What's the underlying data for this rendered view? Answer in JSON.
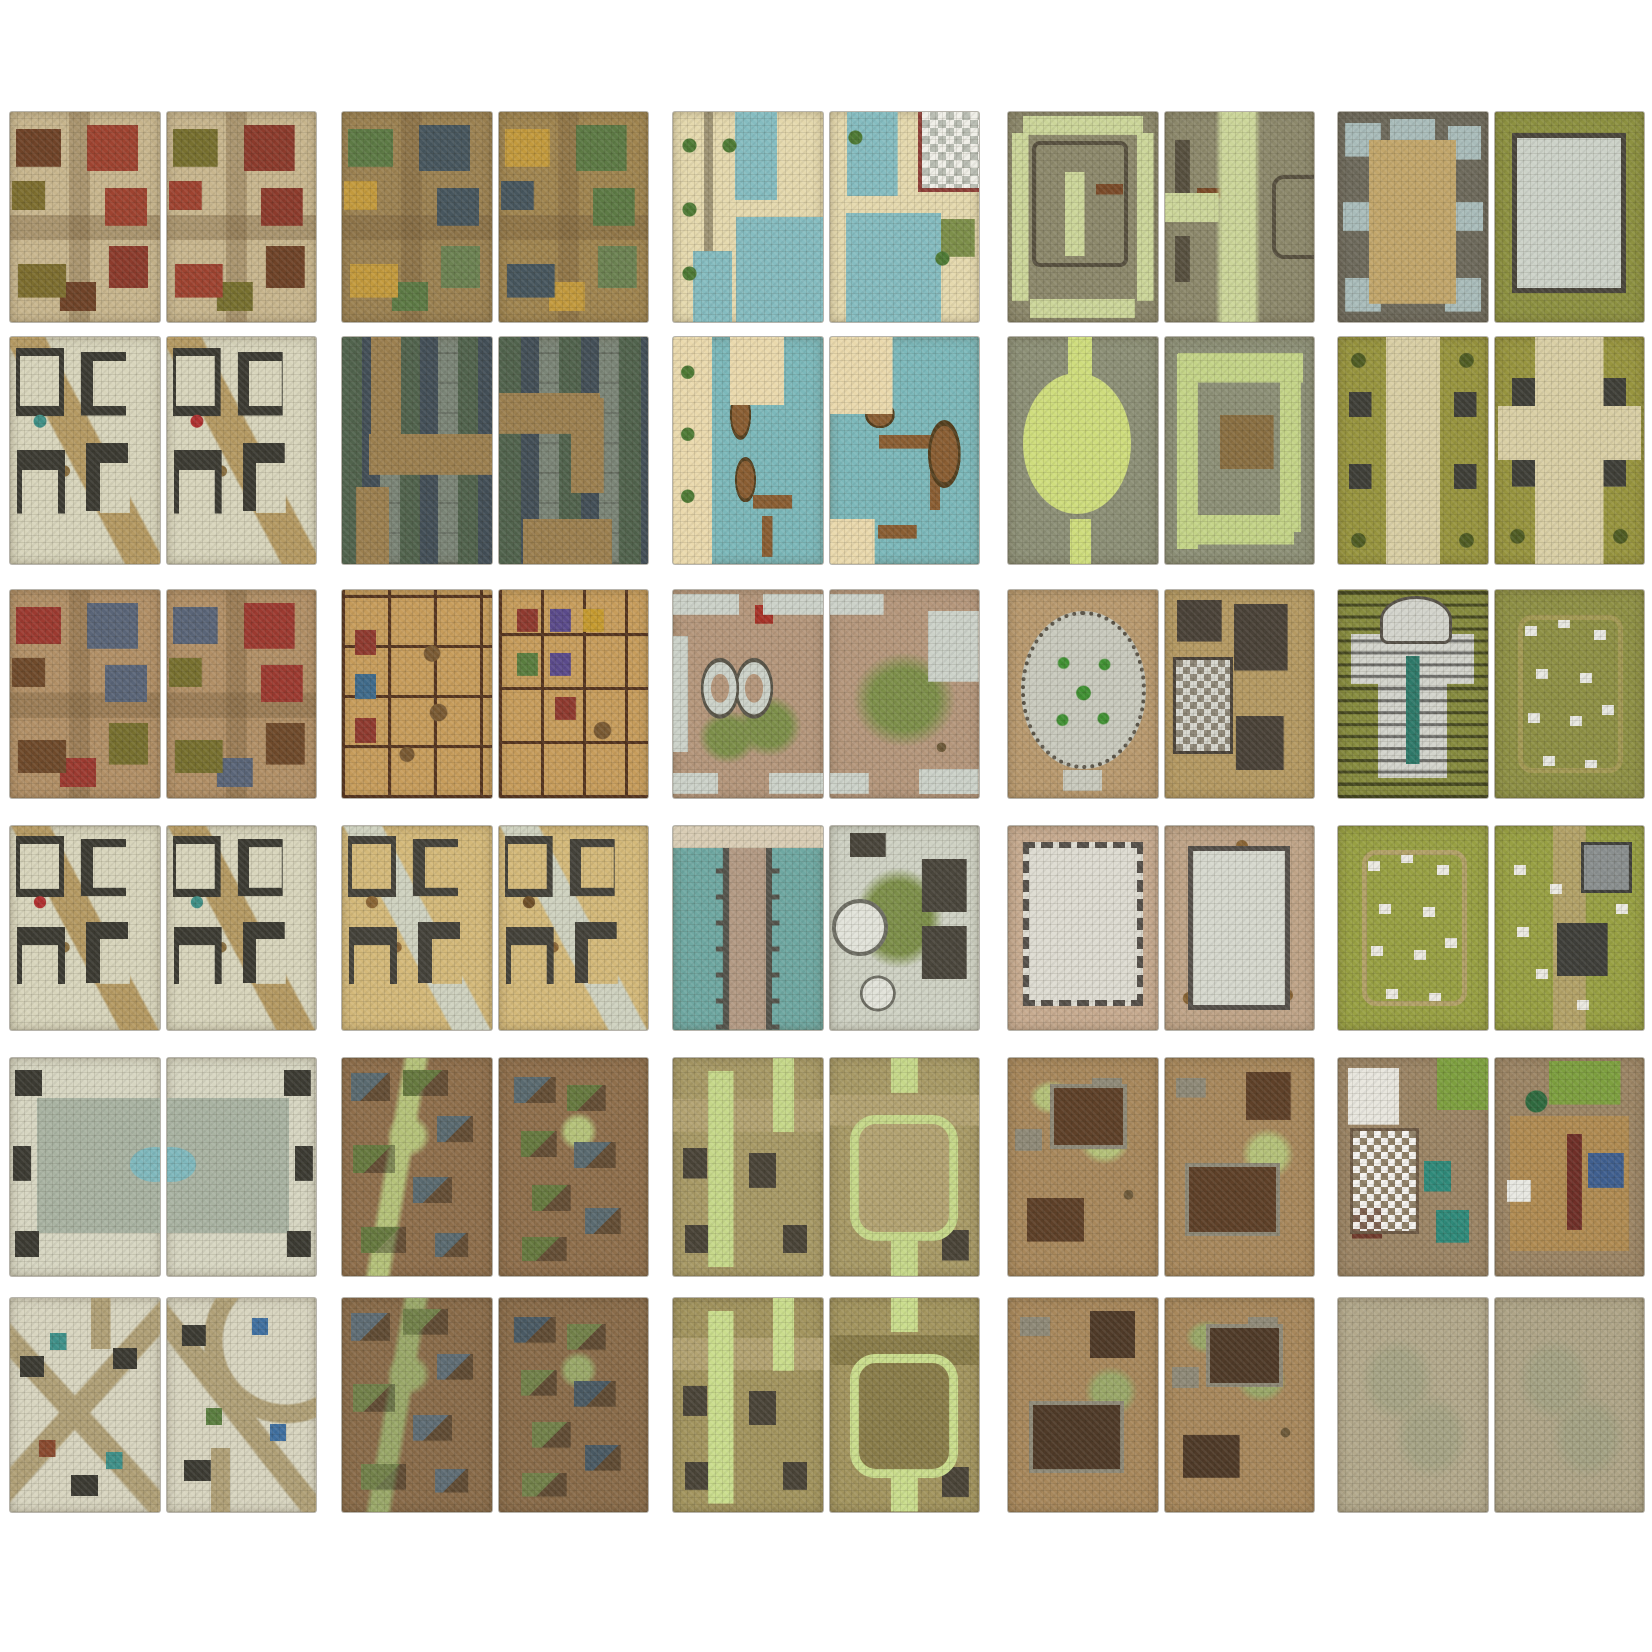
{
  "page": {
    "description": "Grid of 30 fantasy battle-map tiles, each split into two tall panels, arranged five across by six down on a white background",
    "background_color": "#ffffff",
    "grid_rows": 6,
    "grid_cols": 5
  },
  "grid": {
    "tiles": [
      {
        "id": "r1c1",
        "row": 1,
        "col": 1,
        "name": "city-red-rooftops",
        "description": "City crossroads flanked by red, brown and olive hip roofs over cobbled streets",
        "panels": [
          {
            "kind": "city",
            "base": "#c8b68e",
            "accents": [
              "#9e4330",
              "#6f4328",
              "#7d6e2f",
              "#8c3b2c"
            ]
          },
          {
            "kind": "city",
            "base": "#c8b68e",
            "accents": [
              "#8c3b2c",
              "#77702f",
              "#9e4330",
              "#6f4328"
            ]
          }
        ]
      },
      {
        "id": "r1c2",
        "row": 1,
        "col": 2,
        "name": "town-green-rooftops",
        "description": "Town streets winding between slate and green rooftops with gold courtyards",
        "panels": [
          {
            "kind": "city",
            "base": "#9c8252",
            "accents": [
              "#47565e",
              "#5d7a45",
              "#c39a3d",
              "#6c8252"
            ]
          },
          {
            "kind": "city",
            "base": "#a08550",
            "accents": [
              "#5d7a45",
              "#c39a3d",
              "#47565e",
              "#6c8252"
            ]
          }
        ]
      },
      {
        "id": "r1c3",
        "row": 1,
        "col": 3,
        "name": "canal-quarter",
        "description": "Canal quarter with teal waterways, stone quays, trees and a checkered plaza",
        "panels": [
          {
            "kind": "canal",
            "base": "#e5d9ae",
            "accents": [
              "#85bcc0",
              "#4e7a35",
              "#8e4038"
            ]
          },
          {
            "kind": "canal2",
            "base": "#e5d9ae",
            "accents": [
              "#85bcc0",
              "#4e7a35",
              "#b9bdb3"
            ]
          }
        ]
      },
      {
        "id": "r1c4",
        "row": 1,
        "col": 4,
        "name": "garden-maze-ramparts",
        "description": "Walled garden maze with pale green paths between grey stone ramparts",
        "panels": [
          {
            "kind": "dungeon",
            "base": "#8d896c",
            "accents": [
              "#ccd69a",
              "#57503f",
              "#7a4a28"
            ]
          },
          {
            "kind": "dungeon2",
            "base": "#8d896c",
            "accents": [
              "#ccd69a",
              "#57503f",
              "#7a4a28"
            ]
          }
        ]
      },
      {
        "id": "r1c5",
        "row": 1,
        "col": 5,
        "name": "keep-courtyard",
        "description": "Ruined keep courtyard with side chambers and a tiled great-house on grass",
        "panels": [
          {
            "kind": "keepcourt",
            "base": "#6e6a5c",
            "accents": [
              "#c2a66b",
              "#a9bcba"
            ]
          },
          {
            "kind": "keepgrass",
            "base": "#8d9141",
            "accents": [
              "#ccd2c8",
              "#4a463c"
            ]
          }
        ]
      },
      {
        "id": "r2c1",
        "row": 2,
        "col": 1,
        "name": "city-block-interiors",
        "description": "City block interiors with exposed rooms along a dirt crossroads",
        "panels": [
          {
            "kind": "interiors",
            "base": "#d8d5bc",
            "accents": [
              "#3c3b33",
              "#b59a63",
              "#8a6f3f",
              "#3f8f86"
            ]
          },
          {
            "kind": "interiors",
            "base": "#d8d5bc",
            "accents": [
              "#3c3b33",
              "#b59a63",
              "#8a6f3f",
              "#b03030"
            ]
          }
        ]
      },
      {
        "id": "r2c2",
        "row": 2,
        "col": 2,
        "name": "serpentine-street",
        "description": "Serpentine dirt street snaking between grey and green rooftops",
        "panels": [
          {
            "kind": "serp",
            "base": "#7b8577",
            "accents": [
              "#9c8050",
              "#51634d",
              "#434f57"
            ]
          },
          {
            "kind": "serp2",
            "base": "#7b8577",
            "accents": [
              "#9c8050",
              "#51634d",
              "#434f57"
            ]
          }
        ]
      },
      {
        "id": "r2c3",
        "row": 2,
        "col": 3,
        "name": "harbor-docks",
        "description": "Harbor docks with wooden piers and boats on teal water",
        "panels": [
          {
            "kind": "docks",
            "base": "#7cb8ba",
            "accents": [
              "#ead9ad",
              "#8a5e33",
              "#55401f",
              "#4e7a35"
            ]
          },
          {
            "kind": "docks2",
            "base": "#7cb8ba",
            "accents": [
              "#ead9ad",
              "#8a5e33",
              "#55401f",
              "#4e7a35"
            ]
          }
        ]
      },
      {
        "id": "r2c4",
        "row": 2,
        "col": 4,
        "name": "garden-pond-maze",
        "description": "Round green pond in a stone court beside a winding hedge-path maze",
        "panels": [
          {
            "kind": "pond",
            "base": "#8d9077",
            "accents": [
              "#cfdd7d"
            ]
          },
          {
            "kind": "mazeg",
            "base": "#8d9077",
            "accents": [
              "#c4d488",
              "#8a6f42"
            ]
          }
        ]
      },
      {
        "id": "r2c5",
        "row": 2,
        "col": 5,
        "name": "processional-path",
        "description": "Processional gravel path across grass lined with stone monuments and shrubs",
        "panels": [
          {
            "kind": "grasspath",
            "base": "#98953f",
            "accents": [
              "#d9cfa5",
              "#9aa0a2",
              "#4f5c23"
            ]
          },
          {
            "kind": "grasspath2",
            "base": "#98953f",
            "accents": [
              "#d9cfa5",
              "#9aa0a2",
              "#4f5c23"
            ]
          }
        ]
      },
      {
        "id": "r3c1",
        "row": 3,
        "col": 1,
        "name": "city-dirt-streets",
        "description": "Dirt-street city quarter with blue, red and brown rooftops",
        "panels": [
          {
            "kind": "city",
            "base": "#b29067",
            "accents": [
              "#5a6578",
              "#9c3a30",
              "#6f4a2b",
              "#77702f"
            ]
          },
          {
            "kind": "city",
            "base": "#b29067",
            "accents": [
              "#9c3a30",
              "#5a6578",
              "#77702f",
              "#6f4a2b"
            ]
          }
        ]
      },
      {
        "id": "r3c2",
        "row": 3,
        "col": 2,
        "name": "tavern-inn-interior",
        "description": "Tavern and inn interiors with wooden floors, tables and colored beds",
        "panels": [
          {
            "kind": "tavern",
            "base": "#c79d5c",
            "accents": [
              "#54341f",
              "#7a5a33",
              "#8f3a2f",
              "#3f6a8a"
            ]
          },
          {
            "kind": "tavern2",
            "base": "#c79d5c",
            "accents": [
              "#54341f",
              "#7a5a33",
              "#8f3a2f",
              "#5a4a8a"
            ]
          }
        ]
      },
      {
        "id": "r3c3",
        "row": 3,
        "col": 3,
        "name": "weathered-plaza-basins",
        "description": "Weathered plaza with oval stone basins, grass patches and a red cart",
        "panels": [
          {
            "kind": "oldplaza",
            "base": "#b5977c",
            "accents": [
              "#ccd2c9",
              "#7d8f4a",
              "#a83228"
            ]
          },
          {
            "kind": "oldplaza2",
            "base": "#b5977c",
            "accents": [
              "#ccd2c9",
              "#7d8f4a",
              "#a83228"
            ]
          }
        ]
      },
      {
        "id": "r3c4",
        "row": 3,
        "col": 4,
        "name": "round-plaza-house",
        "description": "Circular flagstone plaza ringed by statues beside house interiors with checkered tile",
        "panels": [
          {
            "kind": "plazaround",
            "base": "#b99a6f",
            "accents": [
              "#c9cabe",
              "#3f9032",
              "#5c564a"
            ]
          },
          {
            "kind": "house",
            "base": "#b59a63",
            "accents": [
              "#6f4a2b",
              "#d8d8d0",
              "#4a4238"
            ]
          }
        ]
      },
      {
        "id": "r3c5",
        "row": 3,
        "col": 5,
        "name": "temple-and-graveyard",
        "description": "Domed temple with pews and teal aisle beside a tombstone graveyard",
        "panels": [
          {
            "kind": "temple",
            "base": "#878c3f",
            "accents": [
              "#d3d4cc",
              "#2f7a6a",
              "#58534a"
            ]
          },
          {
            "kind": "graveyard",
            "base": "#8e9045",
            "accents": [
              "#e8e8e2",
              "#a49a55",
              "#8a8f8f"
            ]
          }
        ]
      },
      {
        "id": "r4c1",
        "row": 4,
        "col": 1,
        "name": "city-interiors-crossroads",
        "description": "City interiors at a curved crossroads with scattered furnishings",
        "panels": [
          {
            "kind": "interiors",
            "base": "#d8d5bc",
            "accents": [
              "#3c3b33",
              "#b59a63",
              "#8a6f3f",
              "#b03030"
            ]
          },
          {
            "kind": "interiors",
            "base": "#d8d5bc",
            "accents": [
              "#3c3b33",
              "#b59a63",
              "#8a6f3f",
              "#3f8f86"
            ]
          }
        ]
      },
      {
        "id": "r4c2",
        "row": 4,
        "col": 2,
        "name": "warehouse-interiors",
        "description": "Warehouse interiors with sandy floors, crates and tiled surrounds",
        "panels": [
          {
            "kind": "interiors",
            "base": "#d4b97a",
            "accents": [
              "#44423a",
              "#cfd2c0",
              "#8a6535",
              "#8a6535"
            ]
          },
          {
            "kind": "interiors",
            "base": "#d4b97a",
            "accents": [
              "#44423a",
              "#cfd2c0",
              "#8a6535",
              "#6e4f28"
            ]
          }
        ]
      },
      {
        "id": "r4c3",
        "row": 4,
        "col": 3,
        "name": "causeway-and-towers",
        "description": "Stone causeway over teal water and round towers with small furnished rooms",
        "panels": [
          {
            "kind": "causeway",
            "base": "#6fa8a2",
            "accents": [
              "#b39a84",
              "#55544c",
              "#d9cdb5"
            ]
          },
          {
            "kind": "towers",
            "base": "#cfd2c4",
            "accents": [
              "#e2e3da",
              "#7d8f4a",
              "#4a463c"
            ]
          }
        ]
      },
      {
        "id": "r4c4",
        "row": 4,
        "col": 4,
        "name": "castle-great-hall",
        "description": "Great tiled hall with crenellated walls and a pillared chamber with crates",
        "panels": [
          {
            "kind": "hall",
            "base": "#c7ab90",
            "accents": [
              "#55504a",
              "#dedcd2"
            ]
          },
          {
            "kind": "hall2",
            "base": "#bfa488",
            "accents": [
              "#55504a",
              "#d6d8ce",
              "#8a6535"
            ]
          }
        ]
      },
      {
        "id": "r4c5",
        "row": 4,
        "col": 5,
        "name": "graveyard-mausoleums",
        "description": "Grassy graveyard with scattered headstones, dirt paths and grey mausoleums",
        "panels": [
          {
            "kind": "graveyard",
            "base": "#98a043",
            "accents": [
              "#eceae2",
              "#b3a268",
              "#8a8f8f"
            ]
          },
          {
            "kind": "graveyard2",
            "base": "#98a043",
            "accents": [
              "#eceae2",
              "#b3a268",
              "#8a8f8f"
            ]
          }
        ]
      },
      {
        "id": "r5c1",
        "row": 5,
        "col": 1,
        "name": "grand-plaza-fountain",
        "description": "Grand sunken plaza with an oval fountain pool spanning both panels",
        "panels": [
          {
            "kind": "fountainL",
            "base": "#d7d6c2",
            "accents": [
              "#a9b3a2",
              "#7fb8bd",
              "#3c3b33"
            ]
          },
          {
            "kind": "fountainR",
            "base": "#d7d6c2",
            "accents": [
              "#a9b3a2",
              "#7fb8bd",
              "#3c3b33"
            ]
          }
        ]
      },
      {
        "id": "r5c2",
        "row": 5,
        "col": 2,
        "name": "muddy-village",
        "description": "Muddy village of scattered shacks with slate and moss roofs by a green stream",
        "panels": [
          {
            "kind": "village",
            "base": "#8f6f4c",
            "accents": [
              "#5a6a70",
              "#66793f",
              "#b5c27a"
            ]
          },
          {
            "kind": "village2",
            "base": "#8f6f4c",
            "accents": [
              "#5a6a70",
              "#66793f",
              "#b5c27a"
            ]
          }
        ]
      },
      {
        "id": "r5c3",
        "row": 5,
        "col": 3,
        "name": "green-lane-town",
        "description": "Stone town threaded by pale green lanes and a looped ring road",
        "panels": [
          {
            "kind": "greentown",
            "base": "#a89a66",
            "accents": [
              "#c6d88a",
              "#b3a372",
              "#4a4438"
            ]
          },
          {
            "kind": "moathall",
            "base": "#a89a66",
            "accents": [
              "#c6d88a",
              "#b3a372",
              "#4a4438"
            ]
          }
        ]
      },
      {
        "id": "r5c4",
        "row": 5,
        "col": 4,
        "name": "ruined-settlement",
        "description": "Ruined settlement of broken foundations and collapsed dark floors",
        "panels": [
          {
            "kind": "ruins",
            "base": "#a8885c",
            "accents": [
              "#5e4028",
              "#8f8a78",
              "#b5c27a"
            ]
          },
          {
            "kind": "ruins2",
            "base": "#a8885c",
            "accents": [
              "#5e4028",
              "#8f8a78",
              "#b5c27a"
            ]
          }
        ]
      },
      {
        "id": "r5c5",
        "row": 5,
        "col": 5,
        "name": "manor-interiors",
        "description": "Manor interiors with checkered marble, rugs, wooden floors and walled gardens",
        "panels": [
          {
            "kind": "manorL",
            "base": "#9c8565",
            "accents": [
              "#dedcd4",
              "#2f8a7a",
              "#7d9f3f",
              "#703a2c"
            ]
          },
          {
            "kind": "manorR",
            "base": "#9c8565",
            "accents": [
              "#b08b52",
              "#3f5f8f",
              "#7d9f3f",
              "#6f2f28"
            ]
          }
        ]
      },
      {
        "id": "r6c1",
        "row": 6,
        "col": 1,
        "name": "diagonal-crossroads-city",
        "description": "Dense city crossed by diagonal streets with colored carts and wagons",
        "panels": [
          {
            "kind": "diagcity",
            "base": "#d8d5c0",
            "accents": [
              "#b0a077",
              "#3f9089",
              "#8a4a2f",
              "#3c3b33"
            ]
          },
          {
            "kind": "diagcity2",
            "base": "#d8d5c0",
            "accents": [
              "#b0a077",
              "#3f6f9f",
              "#5a7d3f",
              "#3c3b33"
            ]
          }
        ]
      },
      {
        "id": "r6c2",
        "row": 6,
        "col": 2,
        "name": "mud-hamlet",
        "description": "Mud hamlet of long shacks scattered over brown ground",
        "panels": [
          {
            "kind": "village",
            "base": "#8a6c4a",
            "accents": [
              "#5f6d75",
              "#72814a",
              "#9aa869"
            ]
          },
          {
            "kind": "village2",
            "base": "#8a6c4a",
            "accents": [
              "#4a5a64",
              "#72814a",
              "#9aa869"
            ]
          }
        ]
      },
      {
        "id": "r6c3",
        "row": 6,
        "col": 3,
        "name": "walled-green-lanes",
        "description": "Walled yards along a green lane and a hall ringed by a mossy path",
        "panels": [
          {
            "kind": "greentown",
            "base": "#a3955f",
            "accents": [
              "#cadd8d",
              "#b3a372",
              "#4a4438"
            ]
          },
          {
            "kind": "moathall",
            "base": "#a3955f",
            "accents": [
              "#cadd8d",
              "#8a7d4a",
              "#4a4438"
            ]
          }
        ]
      },
      {
        "id": "r6c4",
        "row": 6,
        "col": 4,
        "name": "collapsed-buildings",
        "description": "Collapsed warehouses and rubble on dusty ground",
        "panels": [
          {
            "kind": "ruins2",
            "base": "#a8885c",
            "accents": [
              "#4f3a28",
              "#8f8a78",
              "#9aa869"
            ]
          },
          {
            "kind": "ruins",
            "base": "#a8885c",
            "accents": [
              "#4f3a28",
              "#8f8a78",
              "#9aa869"
            ]
          }
        ]
      },
      {
        "id": "r6c5",
        "row": 6,
        "col": 5,
        "name": "open-ground",
        "description": "Plain open-ground tiles of mottled cobble and scrub with no structures",
        "panels": [
          {
            "kind": "blank",
            "base": "#b3a98c",
            "accents": [
              "#9aa080"
            ]
          },
          {
            "kind": "blank",
            "base": "#afa588",
            "accents": [
              "#9aa080"
            ]
          }
        ]
      }
    ]
  }
}
